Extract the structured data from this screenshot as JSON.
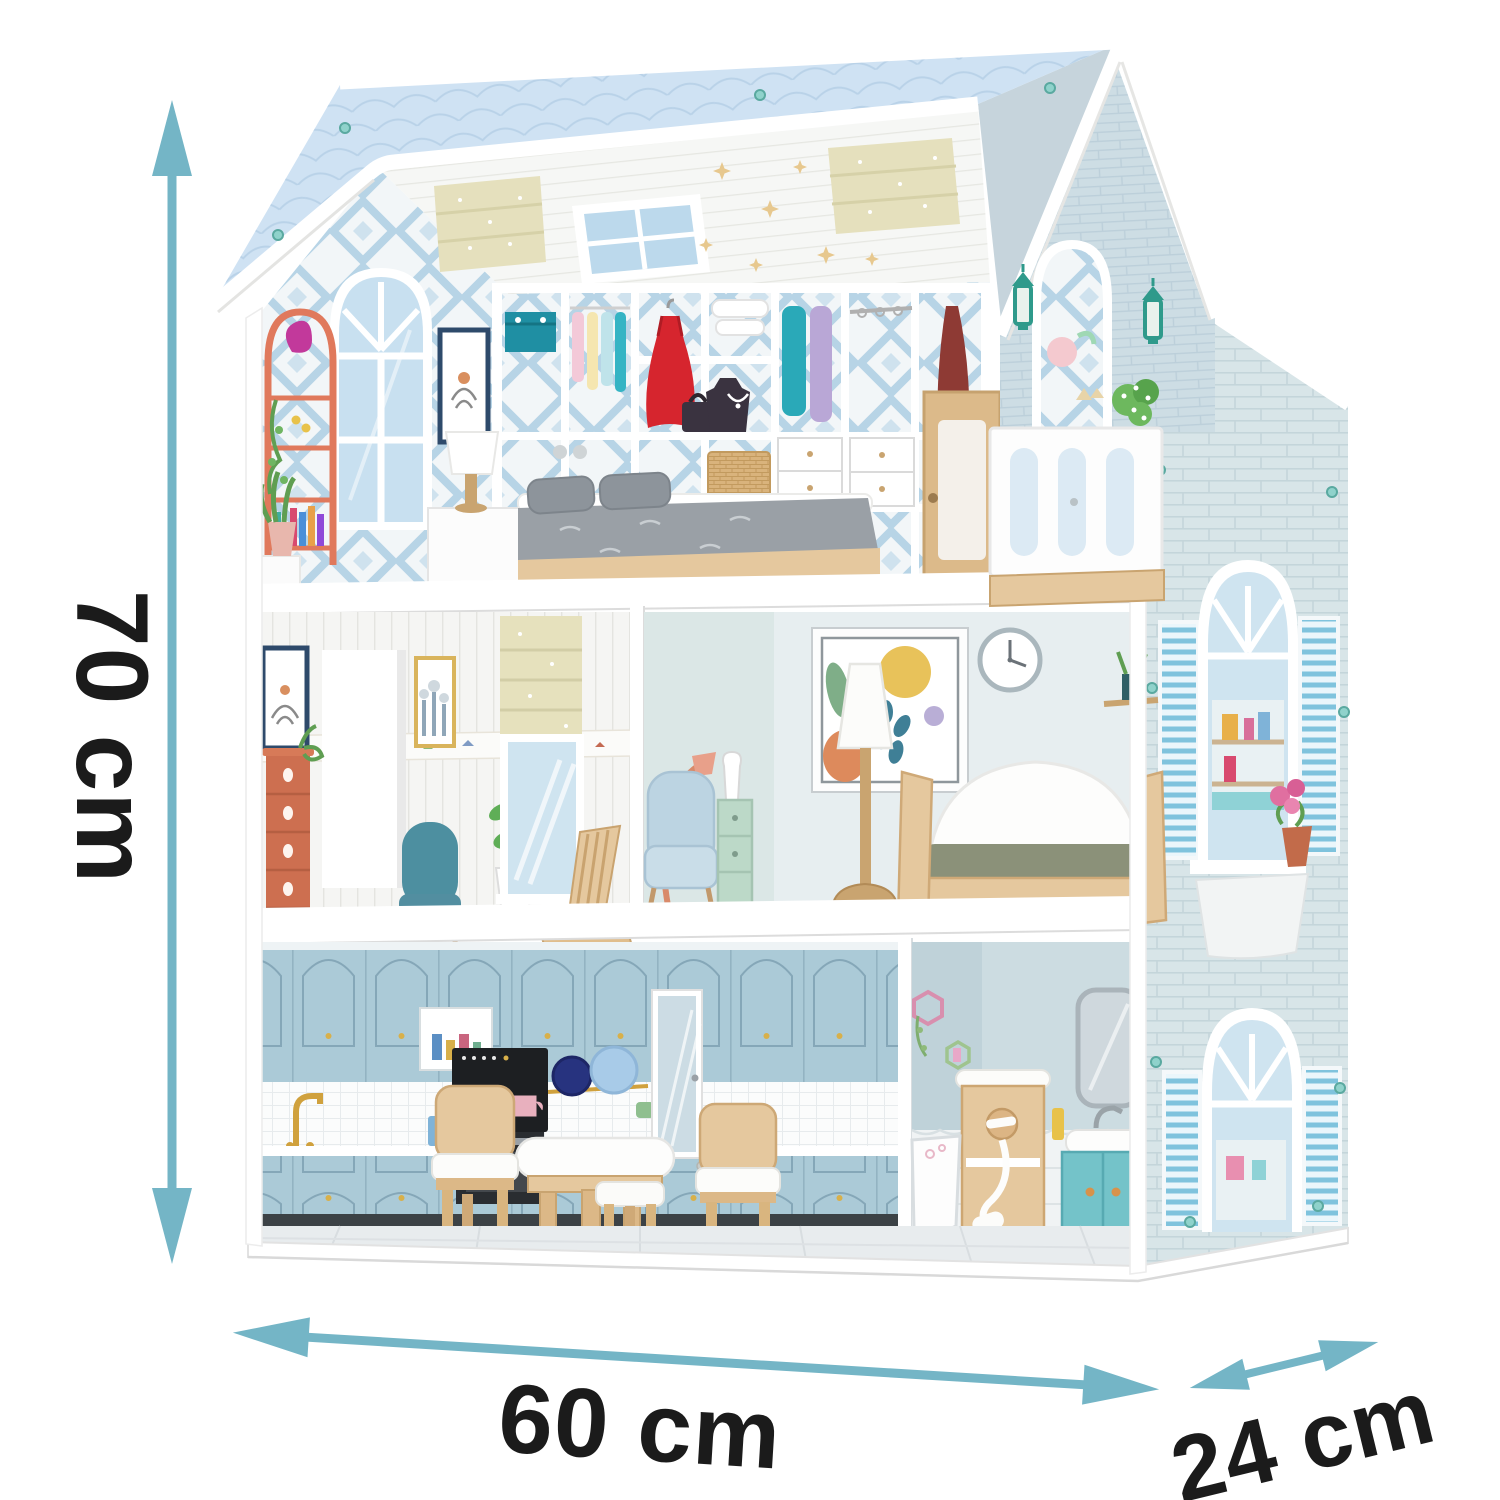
{
  "canvas": {
    "width": 1500,
    "height": 1500,
    "background": "#ffffff"
  },
  "subject": "three-storey wooden dollhouse with furniture, shown with measurement arrows",
  "dimensions": {
    "height_label": "70 cm",
    "width_label": "60 cm",
    "depth_label": "24 cm"
  },
  "colors": {
    "arrow": "#74b5c6",
    "label_text": "#1b1b1b",
    "roof": "#cfe2f3",
    "wall_brick": "#d8e5e8",
    "gable_brick": "#cddde4",
    "kitchen_cabinet": "#abcad7",
    "wood": "#e5c89e",
    "wood_dark": "#c9a470",
    "coral": "#cd6f50",
    "teal_chair": "#4d8fa0",
    "olive": "#8b9179",
    "mint": "#bcd9c8",
    "lantern": "#2f9a8b",
    "dress_red": "#d6252e",
    "window_glass": "#cfe4f0",
    "shutter_blue": "#7fc3dd"
  }
}
